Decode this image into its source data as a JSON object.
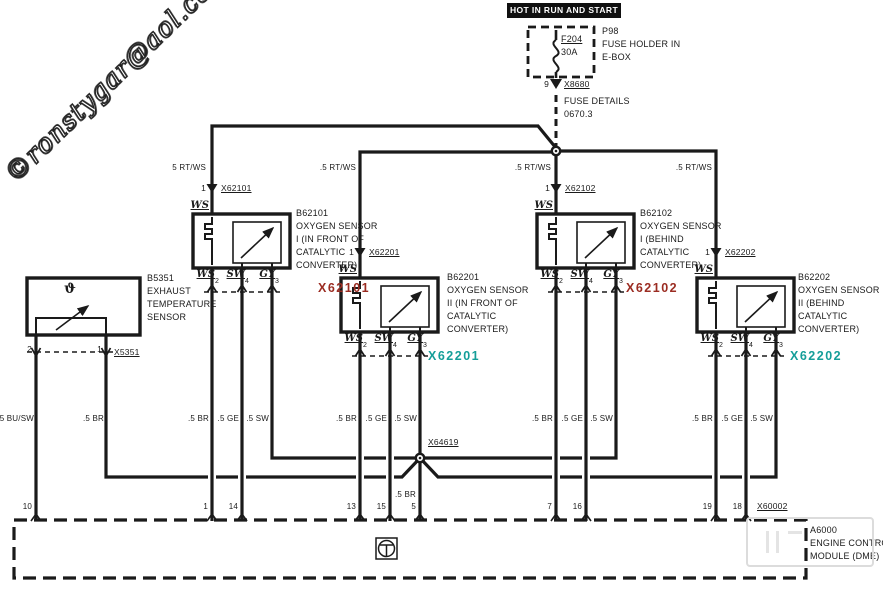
{
  "watermark": "©ronstygar@aol.com",
  "banner": "HOT IN RUN AND START",
  "fuse": {
    "label": "F204",
    "rating": "30A",
    "pin": "9",
    "connector": "X8680",
    "holder_lines": [
      "P98",
      "FUSE HOLDER IN",
      "E-BOX"
    ],
    "details_lines": [
      "FUSE DETAILS",
      "0670.3"
    ]
  },
  "bus_labels": [
    "5 RT/WS",
    ".5 RT/WS",
    ".5 RT/WS",
    ".5 RT/WS"
  ],
  "sensors": [
    {
      "id": "B62101",
      "top_pin": "1",
      "top_wire": "WS",
      "connector": "X62101",
      "name_lines": [
        "B62101",
        "OXYGEN SENSOR",
        "I (IN FRONT OF",
        "CATALYTIC",
        "CONVERTER)"
      ],
      "pins": [
        {
          "label": "WS",
          "num": "2"
        },
        {
          "label": "SW",
          "num": "4"
        },
        {
          "label": "GY",
          "num": "3"
        }
      ],
      "wire_colors": [
        ".5 BR",
        ".5 GE",
        ".5 SW"
      ],
      "label_color": "red"
    },
    {
      "id": "B62102",
      "top_pin": "1",
      "top_wire": "WS",
      "connector": "X62102",
      "name_lines": [
        "B62102",
        "OXYGEN SENSOR",
        "I (BEHIND",
        "CATALYTIC",
        "CONVERTER)"
      ],
      "pins": [
        {
          "label": "WS",
          "num": "2"
        },
        {
          "label": "SW",
          "num": "4"
        },
        {
          "label": "GY",
          "num": "3"
        }
      ],
      "wire_colors": [
        ".5 BR",
        ".5 GE",
        ".5 SW"
      ],
      "label_color": "red"
    },
    {
      "id": "B62201",
      "top_pin": "1",
      "top_wire": "WS",
      "connector": "X62201",
      "name_lines": [
        "B62201",
        "OXYGEN SENSOR",
        "II (IN FRONT OF",
        "CATALYTIC",
        "CONVERTER)"
      ],
      "pins": [
        {
          "label": "WS",
          "num": "2"
        },
        {
          "label": "SW",
          "num": "4"
        },
        {
          "label": "GY",
          "num": "3"
        }
      ],
      "wire_colors": [
        ".5 BR",
        ".5 GE",
        ".5 SW"
      ],
      "label_color": "teal"
    },
    {
      "id": "B62202",
      "top_pin": "1",
      "top_wire": "WS",
      "connector": "X62202",
      "name_lines": [
        "B62202",
        "OXYGEN SENSOR",
        "II (BEHIND",
        "CATALYTIC",
        "CONVERTER)"
      ],
      "pins": [
        {
          "label": "WS",
          "num": "2"
        },
        {
          "label": "SW",
          "num": "4"
        },
        {
          "label": "GY",
          "num": "3"
        }
      ],
      "wire_colors": [
        ".5 BR",
        ".5 GE",
        ".5 SW"
      ],
      "label_color": "teal"
    }
  ],
  "temp_sensor": {
    "id": "B5351",
    "symbol": "ϑ",
    "name_lines": [
      "B5351",
      "EXHAUST",
      "TEMPERATURE",
      "SENSOR"
    ],
    "pins": [
      "2",
      "1"
    ],
    "connector": "X5351",
    "wire_colors": [
      ".5 BU/SW",
      ".5 BR"
    ]
  },
  "splice": {
    "id": "X64619",
    "wire_below": ".5 BR"
  },
  "dme": {
    "id": "A6000",
    "name_lines": [
      "A6000",
      "ENGINE CONTROL",
      "MODULE (DME)"
    ],
    "connector": "X60002",
    "pins": [
      "10",
      "1",
      "14",
      "13",
      "15",
      "5",
      "7",
      "16",
      "19",
      "18"
    ]
  },
  "colors": {
    "line": "#1a1a1a",
    "red_label": "#9b2c22",
    "teal_label": "#159e99"
  }
}
